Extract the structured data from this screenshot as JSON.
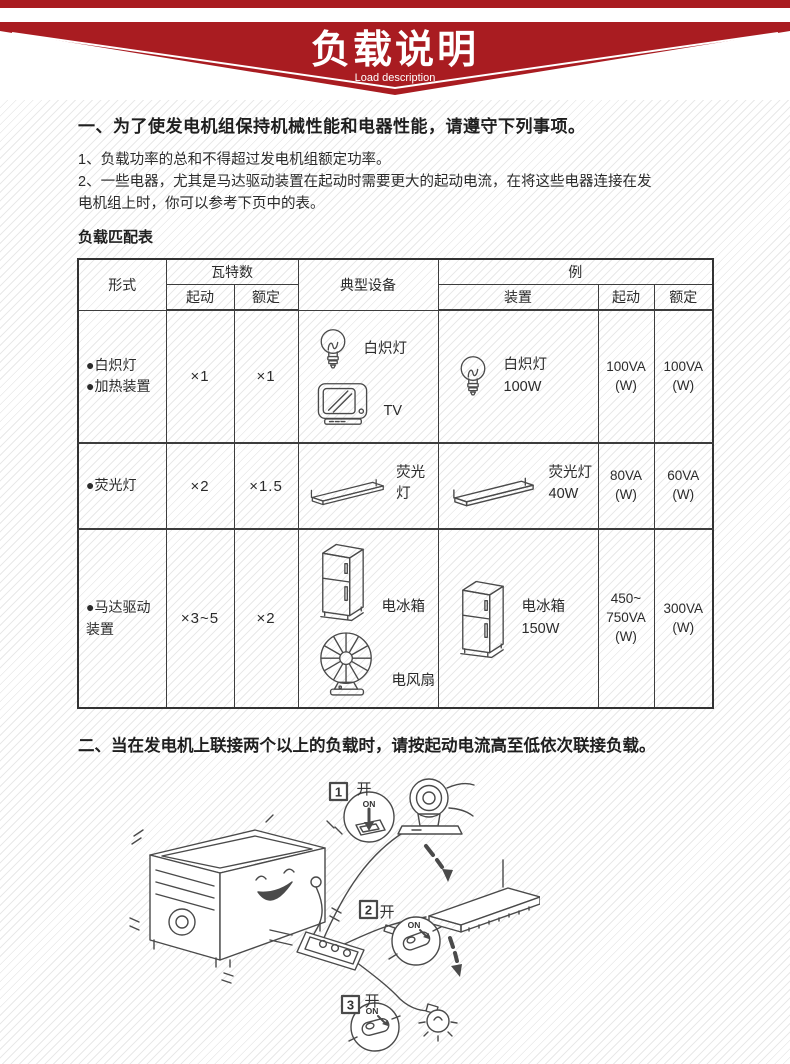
{
  "colors": {
    "banner_red": "#a91c21",
    "line": "#4a4a4a"
  },
  "banner": {
    "title": "负载说明",
    "subtitle": "Load description"
  },
  "section1": {
    "heading": "一、为了使发电机组保持机械性能和电器性能，请遵守下列事项。",
    "item1": "1、负载功率的总和不得超过发电机组额定功率。",
    "item2": "2、一些电器，尤其是马达驱动装置在起动时需要更大的起动电流，在将这些电器连接在发\n电机组上时，你可以参考下页中的表。",
    "table_title": "负载匹配表"
  },
  "table": {
    "header": {
      "type": "形式",
      "watts": "瓦特数",
      "start": "起动",
      "rated": "额定",
      "typical": "典型设备",
      "example": "例",
      "device": "装置",
      "ex_start": "起动",
      "ex_rated": "额定"
    },
    "rows": [
      {
        "type": "●白炽灯\n●加热装置",
        "start": "×1",
        "rated": "×1",
        "typical1": "白炽灯",
        "typical2": "TV",
        "device": "白炽灯\n100W",
        "ex_start": "100VA\n(W)",
        "ex_rated": "100VA\n(W)"
      },
      {
        "type": "●荧光灯",
        "start": "×2",
        "rated": "×1.5",
        "typical1": "荧光灯",
        "device": "荧光灯\n40W",
        "ex_start": "80VA\n(W)",
        "ex_rated": "60VA\n(W)"
      },
      {
        "type": "●马达驱动\n装置",
        "start": "×3~5",
        "rated": "×2",
        "typical1": "电冰箱",
        "typical2": "电风扇",
        "device": "电冰箱\n150W",
        "ex_start": "450~\n750VA\n(W)",
        "ex_rated": "300VA\n(W)"
      }
    ]
  },
  "section2": {
    "heading": "二、当在发电机上联接两个以上的负载时，请按起动电流高至低依次联接负载。"
  },
  "illustration": {
    "step1": {
      "num": "1",
      "switch_label": "开",
      "on": "ON"
    },
    "step2": {
      "num": "2",
      "switch_label": "开",
      "on": "ON"
    },
    "step3": {
      "num": "3",
      "switch_label": "开",
      "on": "ON"
    }
  }
}
